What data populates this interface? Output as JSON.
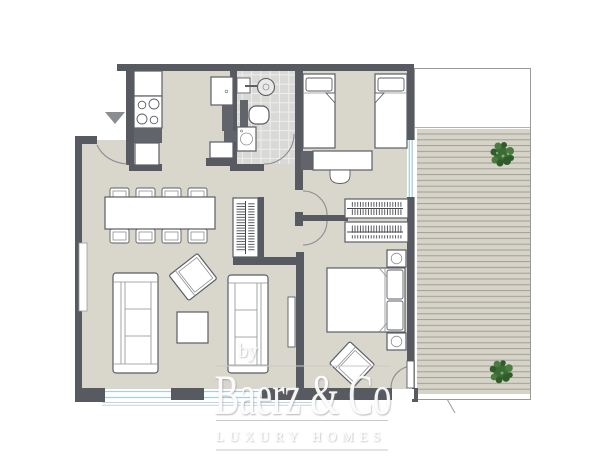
{
  "watermark": {
    "by": "by",
    "brand": "Baerz & Co",
    "tagline": "LUXURY HOMES"
  },
  "colors": {
    "wall": "#575a60",
    "floor": "#d9d6cc",
    "tile": "#d9d9d7",
    "deck": "#d6d3c8",
    "deck_line": "#9b998f",
    "window": "#a9cfdb",
    "plant": "#3c6b33",
    "watermark_line": "#c9c9c9",
    "furniture_outline": "#5b5e63",
    "exterior": "#ffffff"
  },
  "icons": {
    "entrance_marker": "down-triangle",
    "plants": "terrace-shrub"
  }
}
